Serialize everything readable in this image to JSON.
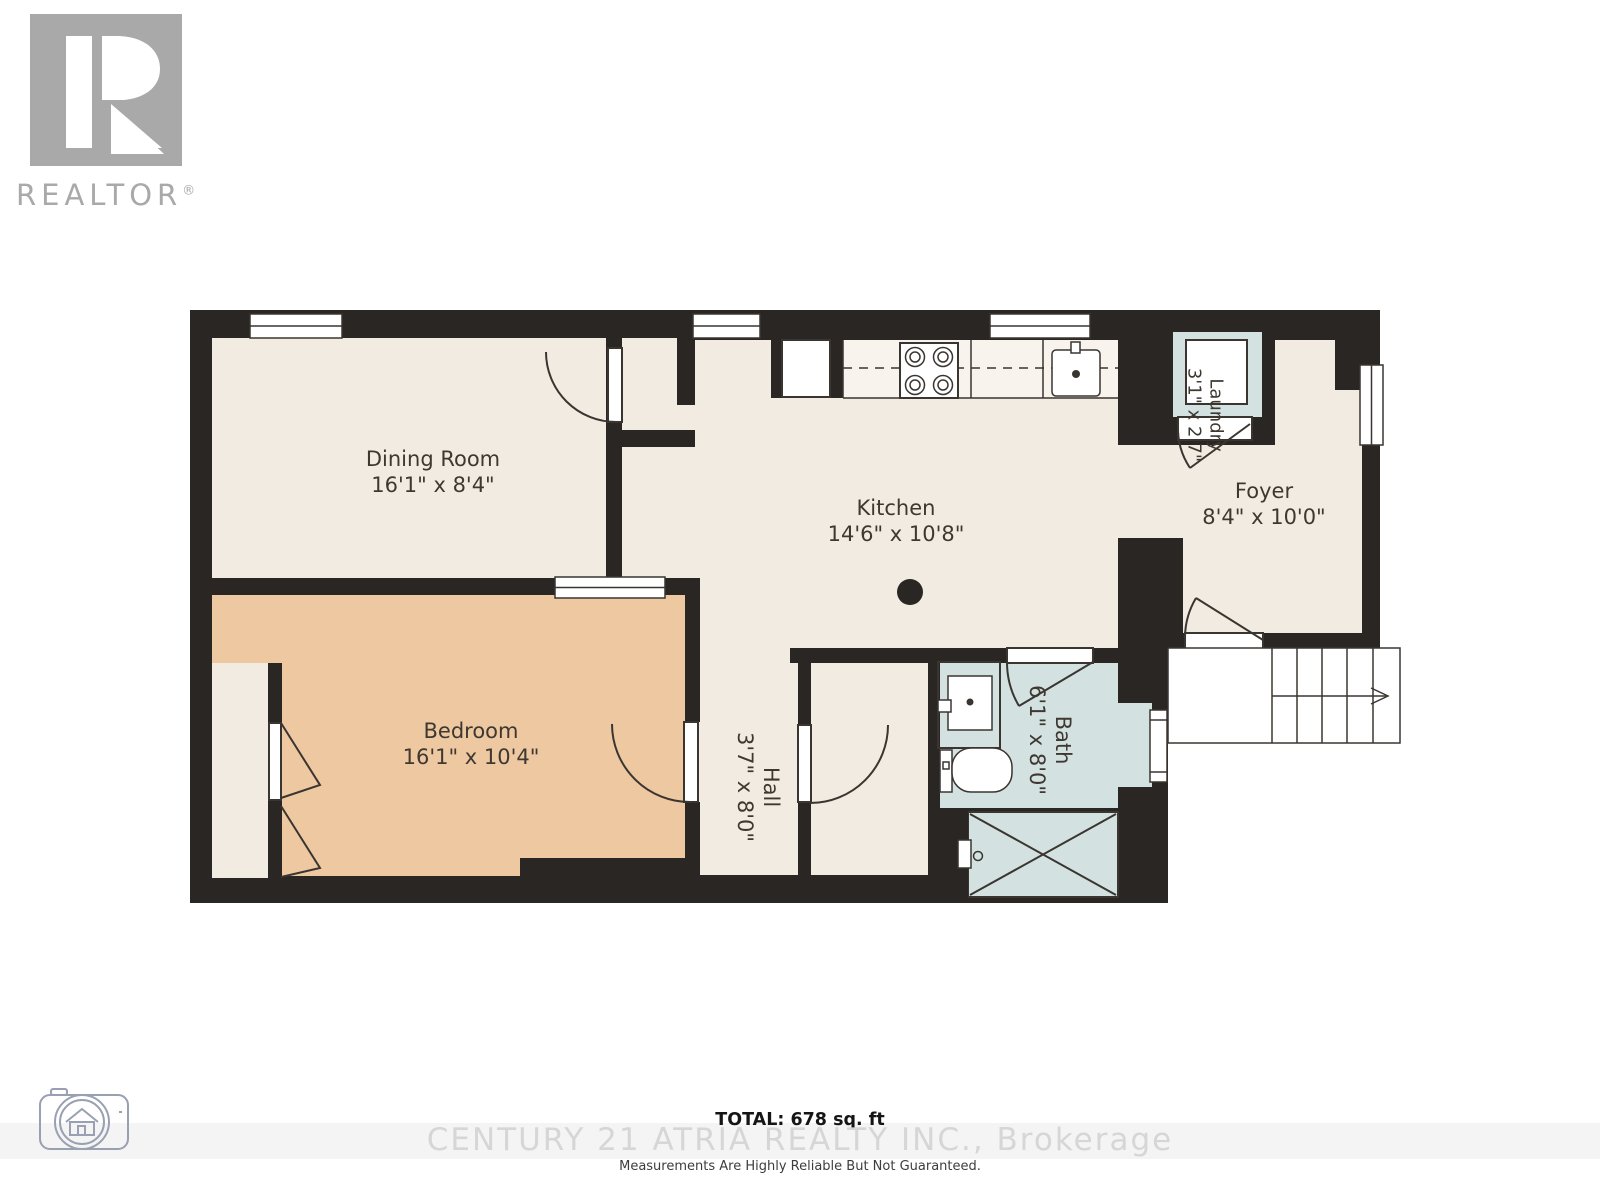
{
  "branding": {
    "realtor_letter": "R",
    "realtor_label": "REALTOR",
    "realtor_reg": "®"
  },
  "floorplan": {
    "rooms": [
      {
        "id": "dining",
        "name": "Dining Room",
        "dims": "16'1\" x 8'4\""
      },
      {
        "id": "kitchen",
        "name": "Kitchen",
        "dims": "14'6\" x 10'8\""
      },
      {
        "id": "foyer",
        "name": "Foyer",
        "dims": "8'4\" x 10'0\""
      },
      {
        "id": "laundry",
        "name": "Laundry",
        "dims": "3'1\" x 2'7\""
      },
      {
        "id": "bedroom",
        "name": "Bedroom",
        "dims": "16'1\" x 10'4\""
      },
      {
        "id": "hall",
        "name": "Hall",
        "dims": "3'7\" x 8'0\""
      },
      {
        "id": "bath",
        "name": "Bath",
        "dims": "6'1\" x 8'0\""
      }
    ]
  },
  "footer": {
    "total": "TOTAL: 678 sq. ft",
    "brokerage": "CENTURY 21 ATRIA REALTY INC., Brokerage",
    "disclaimer": "Measurements Are Highly Reliable But Not Guaranteed."
  },
  "colors": {
    "wall": "#2a2623",
    "floor": "#f2ebe2",
    "bedroom-floor": "#edc8a1",
    "wet-floor": "#d3e2e1",
    "line": "#3a3531",
    "label": "#3e3831",
    "logo-gray": "#a9a9a9",
    "camera-gray": "#99a0b2",
    "watermark": "#d6d6d6"
  }
}
